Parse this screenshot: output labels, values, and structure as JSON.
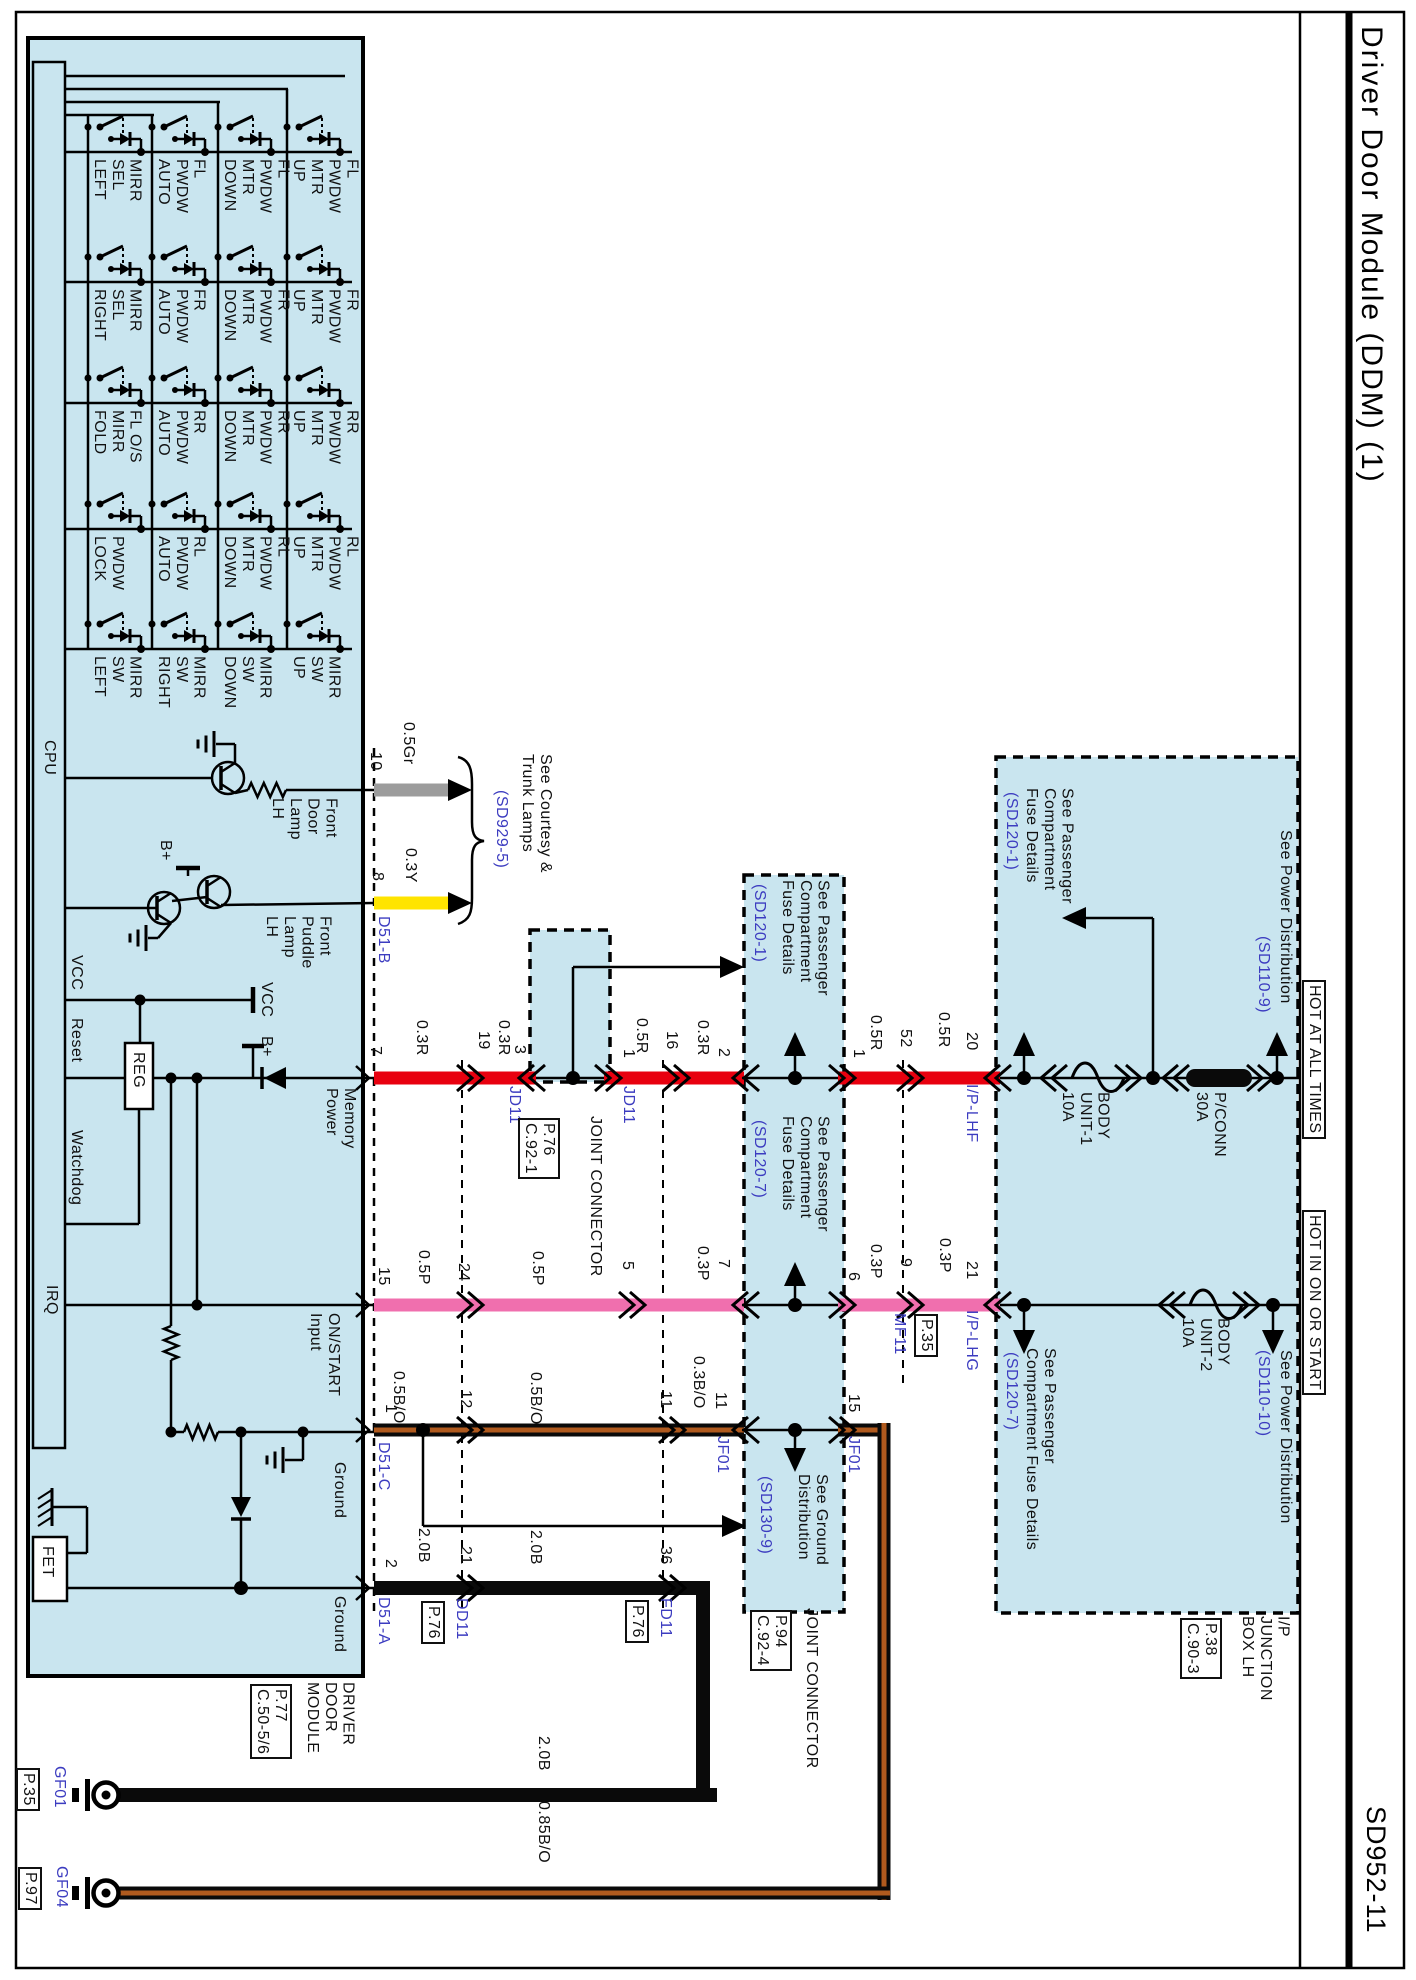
{
  "header": {
    "title": "Driver Door Module (DDM) (1)",
    "code": "SD952-11"
  },
  "colors": {
    "module_fill": "#c9e5ef",
    "wire_red": "#e8000f",
    "wire_pink": "#f06fae",
    "wire_yellow": "#ffe400",
    "wire_gray": "#9c9c9c",
    "wire_black": "#0a0a0a",
    "wire_orange_stripe": "#b05a1e",
    "label_blue": "#3c3cc0"
  },
  "switch_matrix": {
    "rows": [
      {
        "labels": [
          "MIRR\nSEL\nLEFT",
          "FL\nPWDW\nAUTO",
          "FL\nPWDW\nMTR\nDOWN",
          "FL\nPWDW\nMTR\nUP"
        ]
      },
      {
        "labels": [
          "MIRR\nSEL\nRIGHT",
          "FR\nPWDW\nAUTO",
          "FR\nPWDW\nMTR\nDOWN",
          "FR\nPWDW\nMTR\nUP"
        ]
      },
      {
        "labels": [
          "FL O/S\nMIRR\nFOLD",
          "RR\nPWDW\nAUTO",
          "RR\nPWDW\nMTR\nDOWN",
          "RR\nPWDW\nMTR\nUP"
        ]
      },
      {
        "labels": [
          "PWDW\nLOCK",
          "RL\nPWDW\nAUTO",
          "RL\nPWDW\nMTR\nDOWN",
          "RL\nPWDW\nMTR\nUP"
        ]
      },
      {
        "labels": [
          "MIRR\nSW\nLEFT",
          "MIRR\nSW\nRIGHT",
          "MIRR\nSW\nDOWN",
          "MIRR\nSW\nUP"
        ]
      }
    ]
  },
  "labels": [
    {
      "n": "cpu-label",
      "t": "CPU",
      "x": 40,
      "y": 740
    },
    {
      "n": "sig-vcc",
      "t": "VCC",
      "x": 67,
      "y": 955
    },
    {
      "n": "sig-reset",
      "t": "Reset",
      "x": 67,
      "y": 1018
    },
    {
      "n": "sig-watchdog",
      "t": "Watchdog",
      "x": 67,
      "y": 1130
    },
    {
      "n": "sig-irq",
      "t": "IRQ",
      "x": 42,
      "y": 1285
    },
    {
      "n": "reg-label",
      "t": "REG",
      "x": 129,
      "y": 1052
    },
    {
      "n": "fet-label",
      "t": "FET",
      "x": 38,
      "y": 1546
    },
    {
      "n": "vcc-symbol-label",
      "t": "VCC",
      "x": 257,
      "y": 982
    },
    {
      "n": "bplus-label-1",
      "t": "B+",
      "x": 156,
      "y": 840
    },
    {
      "n": "bplus-label-2",
      "t": "B+",
      "x": 257,
      "y": 1036
    },
    {
      "n": "front-door-lamp-label",
      "t": "Front\nDoor\nLamp\nLH",
      "x": 268,
      "y": 798
    },
    {
      "n": "front-puddle-lamp-label",
      "t": "Front\nPuddle\nLamp\nLH",
      "x": 262,
      "y": 916
    },
    {
      "n": "pin-memory-power",
      "t": "Memory\nPower",
      "x": 322,
      "y": 1088
    },
    {
      "n": "pin-onstart-input",
      "t": "ON/START\nInput",
      "x": 306,
      "y": 1313
    },
    {
      "n": "pin-ground-1",
      "t": "Ground",
      "x": 330,
      "y": 1462
    },
    {
      "n": "pin-ground-2",
      "t": "Ground",
      "x": 330,
      "y": 1596
    },
    {
      "n": "module-name",
      "t": "DRIVER\nDOOR\nMODULE",
      "x": 303,
      "y": 1682
    },
    {
      "n": "module-ref",
      "t": "P.77\nC.50-5/6",
      "x": 250,
      "y": 1684,
      "box": 1
    },
    {
      "n": "pin-10",
      "t": "10",
      "x": 366,
      "y": 752
    },
    {
      "n": "wire-0p5gr",
      "t": "0.5Gr",
      "x": 399,
      "y": 722
    },
    {
      "n": "pin-8",
      "t": "8",
      "x": 368,
      "y": 872
    },
    {
      "n": "wire-0p3y",
      "t": "0.3Y",
      "x": 401,
      "y": 848
    },
    {
      "n": "conn-d51-b",
      "t": "D51-B",
      "x": 374,
      "y": 916,
      "c": "blue"
    },
    {
      "n": "see-courtesy-trunk",
      "t": "See Courtesy &\nTrunk Lamps",
      "x": 518,
      "y": 754
    },
    {
      "n": "ref-sd929-5",
      "t": "(SD929-5)",
      "x": 492,
      "y": 790,
      "c": "blue"
    },
    {
      "n": "pin-7",
      "t": "7",
      "x": 366,
      "y": 1046
    },
    {
      "n": "wire-0p3r-1",
      "t": "0.3R",
      "x": 412,
      "y": 1020
    },
    {
      "n": "pin-19",
      "t": "19",
      "x": 474,
      "y": 1031
    },
    {
      "n": "wire-0p3r-2",
      "t": "0.3R",
      "x": 494,
      "y": 1020
    },
    {
      "n": "pin-3",
      "t": "3",
      "x": 510,
      "y": 1045
    },
    {
      "n": "conn-jd11-left",
      "t": "JD11",
      "x": 505,
      "y": 1086,
      "c": "blue"
    },
    {
      "n": "pin-1-jd11",
      "t": "1",
      "x": 619,
      "y": 1049
    },
    {
      "n": "wire-0p5r-1",
      "t": "0.5R",
      "x": 632,
      "y": 1018
    },
    {
      "n": "pin-16",
      "t": "16",
      "x": 662,
      "y": 1031
    },
    {
      "n": "wire-0p3r-3",
      "t": "0.3R",
      "x": 693,
      "y": 1020
    },
    {
      "n": "pin-2-jf01",
      "t": "2",
      "x": 714,
      "y": 1048
    },
    {
      "n": "conn-jd11-right",
      "t": "JD11",
      "x": 619,
      "y": 1086,
      "c": "blue"
    },
    {
      "n": "jd11-joint-connector",
      "t": "JOINT CONNECTOR",
      "x": 586,
      "y": 1116
    },
    {
      "n": "jd11-ref",
      "t": "P.76\nC.92-1",
      "x": 518,
      "y": 1118,
      "box": 1
    },
    {
      "n": "pin-15",
      "t": "15",
      "x": 374,
      "y": 1267
    },
    {
      "n": "wire-0p5p-1",
      "t": "0.5P",
      "x": 414,
      "y": 1250
    },
    {
      "n": "pin-24",
      "t": "24",
      "x": 454,
      "y": 1263
    },
    {
      "n": "wire-0p5p-2",
      "t": "0.5P",
      "x": 528,
      "y": 1251
    },
    {
      "n": "pin-5",
      "t": "5",
      "x": 618,
      "y": 1261
    },
    {
      "n": "wire-0p3p-1",
      "t": "0.3P",
      "x": 693,
      "y": 1246
    },
    {
      "n": "pin-7-jf01",
      "t": "7",
      "x": 714,
      "y": 1259
    },
    {
      "n": "conn-jf01-left",
      "t": "JF01",
      "x": 713,
      "y": 1436,
      "c": "blue"
    },
    {
      "n": "pin-6",
      "t": "6",
      "x": 844,
      "y": 1272
    },
    {
      "n": "wire-0p3p-2",
      "t": "0.3P",
      "x": 866,
      "y": 1244
    },
    {
      "n": "pin-9",
      "t": "9",
      "x": 896,
      "y": 1258
    },
    {
      "n": "conn-mf11",
      "t": "MF11",
      "x": 890,
      "y": 1313,
      "c": "blue"
    },
    {
      "n": "mf11-ref",
      "t": "P.35",
      "x": 914,
      "y": 1314,
      "box": 1
    },
    {
      "n": "wire-0p3p-3",
      "t": "0.3P",
      "x": 935,
      "y": 1238
    },
    {
      "n": "pin-21-ip",
      "t": "21",
      "x": 962,
      "y": 1261
    },
    {
      "n": "conn-ip-lhg",
      "t": "I/P-LHG",
      "x": 962,
      "y": 1310,
      "c": "blue"
    },
    {
      "n": "conn-ip-lhf",
      "t": "I/P-LHF",
      "x": 962,
      "y": 1084,
      "c": "blue"
    },
    {
      "n": "wire-0p5r-2",
      "t": "0.5R",
      "x": 934,
      "y": 1012
    },
    {
      "n": "pin-20",
      "t": "20",
      "x": 962,
      "y": 1032
    },
    {
      "n": "pin-52",
      "t": "52",
      "x": 896,
      "y": 1029
    },
    {
      "n": "wire-0p5r-3",
      "t": "0.5R",
      "x": 866,
      "y": 1015
    },
    {
      "n": "pin-1-jf01",
      "t": "1",
      "x": 849,
      "y": 1049
    },
    {
      "n": "conn-jf01-right",
      "t": "JF01",
      "x": 844,
      "y": 1436,
      "c": "blue"
    },
    {
      "n": "pin-15-jf01",
      "t": "15",
      "x": 844,
      "y": 1394
    },
    {
      "n": "pin-11-jf01",
      "t": "11",
      "x": 711,
      "y": 1392
    },
    {
      "n": "wire-0p3bo",
      "t": "0.3B/O",
      "x": 689,
      "y": 1356
    },
    {
      "n": "pin-11-fd11",
      "t": "11",
      "x": 656,
      "y": 1391
    },
    {
      "n": "wire-0p5bo-2",
      "t": "0.5B/O",
      "x": 526,
      "y": 1372
    },
    {
      "n": "pin-12",
      "t": "12",
      "x": 456,
      "y": 1390
    },
    {
      "n": "wire-0p5bo-1",
      "t": "0.5B/O",
      "x": 389,
      "y": 1371
    },
    {
      "n": "pin-1-d51c",
      "t": "1",
      "x": 381,
      "y": 1404
    },
    {
      "n": "pin-21-dd11",
      "t": "21",
      "x": 456,
      "y": 1546
    },
    {
      "n": "wire-2p0b-1",
      "t": "2.0B",
      "x": 414,
      "y": 1528
    },
    {
      "n": "wire-2p0b-2",
      "t": "2.0B",
      "x": 526,
      "y": 1530
    },
    {
      "n": "pin-36",
      "t": "36",
      "x": 656,
      "y": 1546
    },
    {
      "n": "pin-2-d51a",
      "t": "2",
      "x": 381,
      "y": 1559
    },
    {
      "n": "conn-dd11",
      "t": "DD11",
      "x": 452,
      "y": 1598,
      "c": "blue"
    },
    {
      "n": "dd11-ref",
      "t": "P.76",
      "x": 421,
      "y": 1601,
      "box": 1
    },
    {
      "n": "conn-fd11",
      "t": "FD11",
      "x": 656,
      "y": 1598,
      "c": "blue"
    },
    {
      "n": "fd11-ref",
      "t": "P.76",
      "x": 625,
      "y": 1600,
      "box": 1
    },
    {
      "n": "conn-d51-c",
      "t": "D51-C",
      "x": 374,
      "y": 1442,
      "c": "blue"
    },
    {
      "n": "conn-d51-a",
      "t": "D51-A",
      "x": 374,
      "y": 1597,
      "c": "blue"
    },
    {
      "n": "jf01-see-fuse-1",
      "t": "See Passenger\nCompartment\nFuse Details",
      "x": 778,
      "y": 880
    },
    {
      "n": "jf01-see-fuse-1-ref",
      "t": "(SD120-1)",
      "x": 750,
      "y": 884,
      "c": "blue"
    },
    {
      "n": "jf01-see-fuse-7",
      "t": "See Passenger\nCompartment\nFuse Details",
      "x": 778,
      "y": 1116
    },
    {
      "n": "jf01-see-fuse-7-ref",
      "t": "(SD120-7)",
      "x": 750,
      "y": 1120,
      "c": "blue"
    },
    {
      "n": "jf01-see-ground",
      "t": "See Ground\nDistribution",
      "x": 794,
      "y": 1474
    },
    {
      "n": "jf01-see-ground-ref",
      "t": "(SD130-9)",
      "x": 756,
      "y": 1476,
      "c": "blue"
    },
    {
      "n": "jf01-ref",
      "t": "P.94\nC.92-4",
      "x": 750,
      "y": 1610,
      "box": 1
    },
    {
      "n": "jf01-joint-connector",
      "t": "JOINT CONNECTOR",
      "x": 802,
      "y": 1608
    },
    {
      "n": "ip-see-fuse-1",
      "t": "See Passenger\nCompartment\nFuse Details",
      "x": 1022,
      "y": 788
    },
    {
      "n": "ip-see-fuse-1-ref",
      "t": "(SD120-1)",
      "x": 1002,
      "y": 792,
      "c": "blue"
    },
    {
      "n": "fuse-body-unit-1",
      "t": "BODY\nUNIT-1\n10A",
      "x": 1058,
      "y": 1092
    },
    {
      "n": "fuse-pconn",
      "t": "P/CONN\n30A",
      "x": 1192,
      "y": 1092
    },
    {
      "n": "ip-see-power-9",
      "t": "See Power Distribution",
      "x": 1276,
      "y": 830
    },
    {
      "n": "ip-see-power-9-ref",
      "t": "(SD110-9)",
      "x": 1254,
      "y": 936,
      "c": "blue"
    },
    {
      "n": "hot-at-all-times",
      "t": "HOT AT ALL TIMES",
      "x": 1302,
      "y": 980,
      "box": 1
    },
    {
      "n": "hot-in-on-or-start",
      "t": "HOT IN ON OR START",
      "x": 1302,
      "y": 1210,
      "box": 1
    },
    {
      "n": "ip-see-fuse-7",
      "t": "See Passenger\nCompartment Fuse Details",
      "x": 1022,
      "y": 1348
    },
    {
      "n": "ip-see-fuse-7-ref",
      "t": "(SD120-7)",
      "x": 1002,
      "y": 1352,
      "c": "blue"
    },
    {
      "n": "fuse-body-unit-2",
      "t": "BODY\nUNIT-2\n10A",
      "x": 1178,
      "y": 1318
    },
    {
      "n": "ip-see-power-10",
      "t": "See Power Distribution",
      "x": 1276,
      "y": 1350
    },
    {
      "n": "ip-see-power-10-ref",
      "t": "(SD110-10)",
      "x": 1254,
      "y": 1350,
      "c": "blue"
    },
    {
      "n": "ip-junction-box",
      "t": "I/P\nJUNCTION\nBOX LH",
      "x": 1238,
      "y": 1616
    },
    {
      "n": "ip-junction-ref",
      "t": "P.38\nC.90-3",
      "x": 1180,
      "y": 1618,
      "box": 1
    },
    {
      "n": "ground-gf01",
      "t": "GF01",
      "x": 50,
      "y": 1766,
      "c": "blue"
    },
    {
      "n": "gf01-ref",
      "t": "P.35",
      "x": 16,
      "y": 1768,
      "box": 1
    },
    {
      "n": "ground-gf04",
      "t": "GF04",
      "x": 52,
      "y": 1866,
      "c": "blue"
    },
    {
      "n": "gf04-ref",
      "t": "P.97",
      "x": 18,
      "y": 1867,
      "box": 1
    },
    {
      "n": "wire-2p0b-3",
      "t": "2.0B",
      "x": 534,
      "y": 1736
    },
    {
      "n": "wire-0p85bo",
      "t": "0.85B/O",
      "x": 534,
      "y": 1801
    }
  ]
}
